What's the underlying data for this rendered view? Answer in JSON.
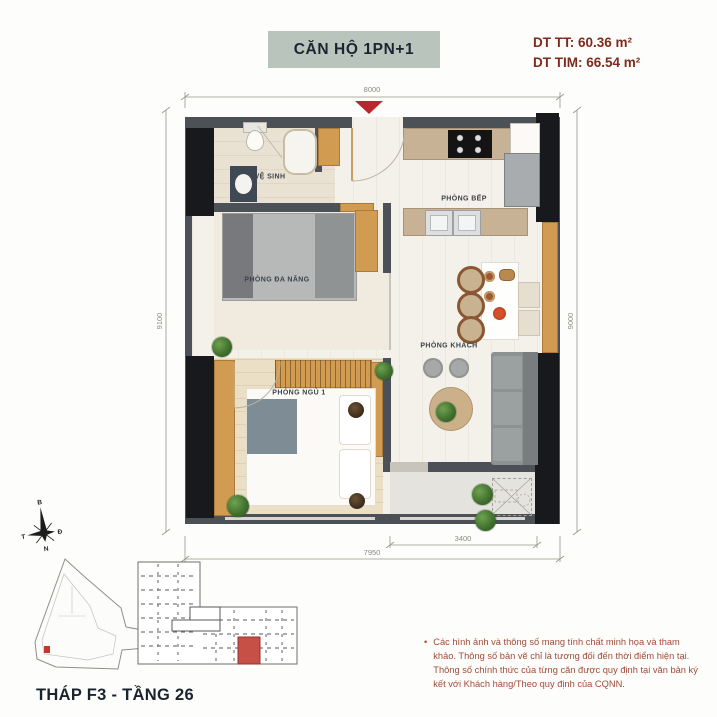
{
  "header": {
    "unit_title": "CĂN HỘ 1PN+1",
    "area_net": "DT TT: 60.36 m²",
    "area_gross": "DT TIM: 66.54 m²"
  },
  "rooms": {
    "bathroom": "VỆ SINH",
    "multipurpose": "PHÒNG ĐA NĂNG",
    "kitchen": "PHÒNG BẾP",
    "living": "PHÒNG KHÁCH",
    "bedroom1": "PHÒNG NGỦ 1"
  },
  "dimensions": {
    "top": "8000",
    "left": "9100",
    "right": "9000",
    "bottom_partial": "3400",
    "bottom_total": "7950"
  },
  "compass": {
    "north": "B",
    "east": "Đ",
    "south": "N",
    "west": "T"
  },
  "locator": {
    "caption": "THÁP F3 - TẦNG 26"
  },
  "disclaimer": {
    "bullet": "•",
    "text": "Các hình ảnh và thông số mang tính chất minh họa và tham khảo. Thông số bản vẽ chỉ là tương đối đến thời điểm hiện tại. Thông số chính thức của từng căn được quy định tại văn bản ký kết với Khách hàng/Theo quy định của CQNN."
  },
  "colors": {
    "accent_red": "#B8282E",
    "highlight_unit": "#C65045",
    "title_bg": "#B9C4BD",
    "title_text": "#1B2530",
    "area_text": "#7E2A1C",
    "disclaimer_text": "#A04B38",
    "wall": "#4B5156",
    "column": "#17191D",
    "wood": "#D29B52"
  }
}
